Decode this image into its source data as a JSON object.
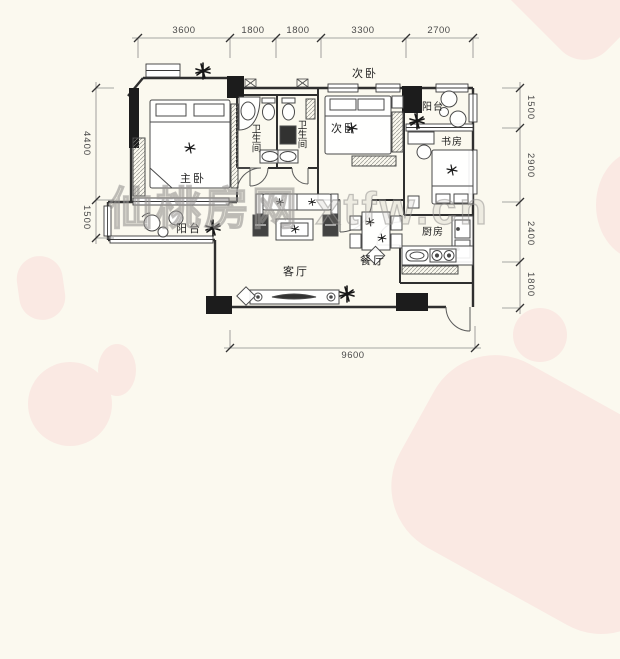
{
  "watermark": {
    "text": "仙桃房网 xtfw.cn"
  },
  "rooms": {
    "bedroom_top_outside": "次卧",
    "master_bedroom": "主卧",
    "bathroom_1": "卫生间",
    "bathroom_2": "卫生间",
    "bedroom_mid": "次卧",
    "balcony_top": "阳台",
    "study": "书房",
    "kitchen": "厨房",
    "dining": "餐厅",
    "living": "客厅",
    "balcony_bottom": "阳台"
  },
  "dimensions": {
    "top": [
      "3600",
      "1800",
      "1800",
      "3300",
      "2700"
    ],
    "bottom": [
      "9600"
    ],
    "left": [
      "4400",
      "1500"
    ],
    "right": [
      "1500",
      "2900",
      "2400",
      "1800"
    ]
  },
  "colors": {
    "page_bg": "#FBF9EF",
    "blob": "#FAE9E3",
    "wall": "#2F2F2F",
    "dimension": "#8A8A8A"
  }
}
